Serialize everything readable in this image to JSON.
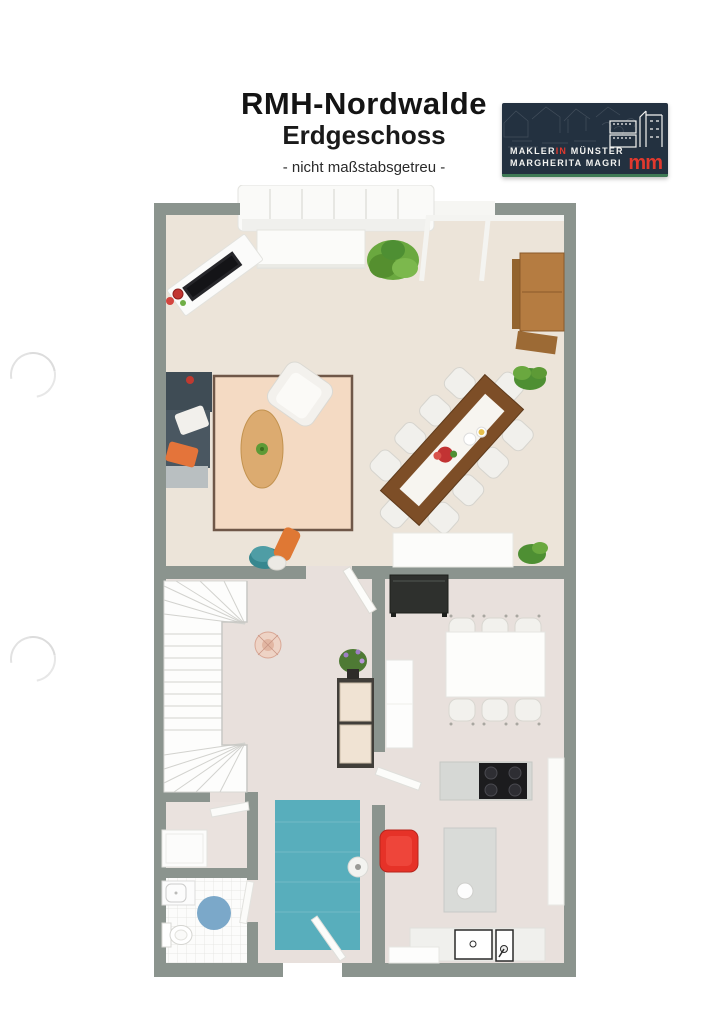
{
  "header": {
    "title": "RMH-Nordwalde",
    "subtitle": "Erdgeschoss",
    "note": "- nicht maßstabsgetreu -"
  },
  "logo": {
    "line1_pre": "MAKLER",
    "line1_accent": "IN",
    "line1_post": " MÜNSTER",
    "line2": "MARGHERITA MAGRI",
    "monogram": "mm",
    "background_color": "#233140",
    "accent_color": "#e0392e",
    "underline_color": "#3f7a55"
  },
  "floorplan": {
    "colors": {
      "wall": "#8b948e",
      "living_floor": "#ece4d9",
      "lower_floor": "#e8e0dc",
      "living_rug": "#f4dac3",
      "teal_rug": "#58aebc",
      "bath_rug": "#7ba8c9",
      "corner_sofa": "#4a5761",
      "accent_armchair": "#e63228",
      "wood_cabinet": "#b57c41",
      "dining_table_wood": "#7d4e27"
    }
  }
}
